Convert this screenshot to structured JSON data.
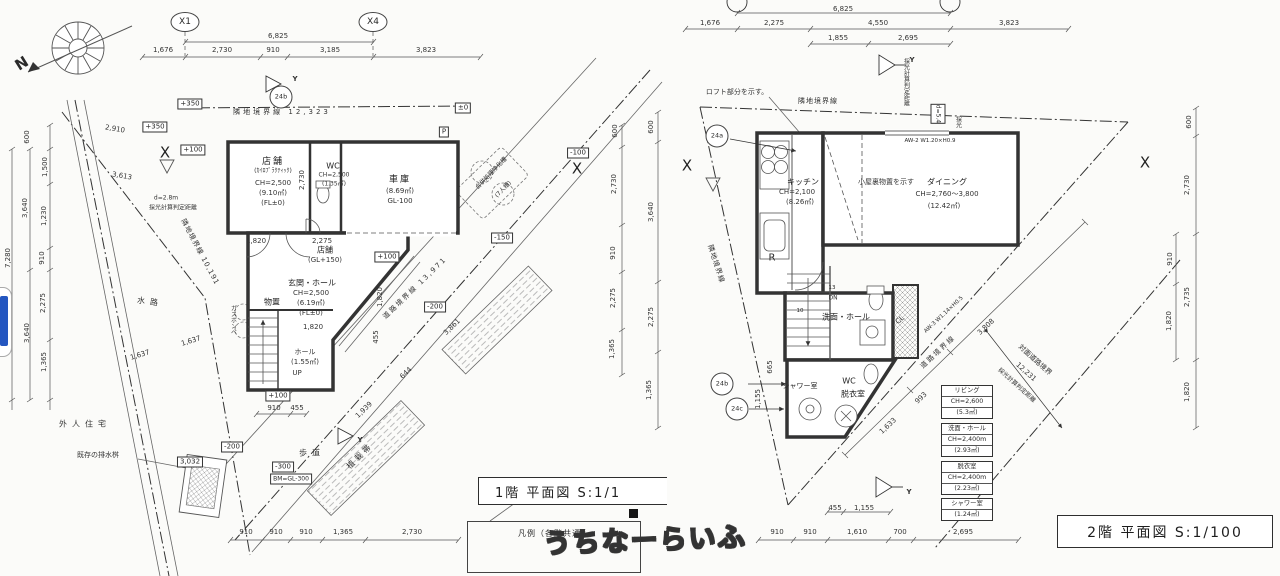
{
  "watermark": {
    "text": "うちなーらいふ"
  },
  "compass": {
    "north": "N"
  },
  "plan1": {
    "title": "1階 平面図 S:1/1",
    "legend_title": "凡例（各階共通）",
    "grid": {
      "x1": "X1",
      "x4": "X4"
    },
    "dims": {
      "top_total": "6,825",
      "top": [
        "1,676",
        "2,730",
        "910",
        "3,185",
        "3,823"
      ],
      "left": [
        "600",
        "1,500",
        "1,230",
        "910",
        "3,640",
        "7,280",
        "2,275",
        "1,365",
        "3,640"
      ],
      "right": [
        "600",
        "2,730",
        "910",
        "2,275",
        "1,365"
      ],
      "bottom": [
        "910",
        "910",
        "910",
        "1,365",
        "2,730"
      ],
      "bottom_sub": [
        "910",
        "455"
      ],
      "inner": {
        "a": "1,820",
        "b": "2,275",
        "c": "2,730",
        "d": "1,820",
        "e": "1,820",
        "f": "455",
        "g": "3,861",
        "h": "644",
        "i": "1,939",
        "j": "1,637",
        "k": "1,637",
        "l": "2,910",
        "m": "3,613"
      }
    },
    "levels": {
      "l1": "+350",
      "l2": "+350",
      "l3": "+100",
      "l4": "±0",
      "l5": "-100",
      "l6": "-150",
      "l7": "+100",
      "l8": "-200",
      "l9": "+100",
      "l10": "-200",
      "l11": "-300",
      "l12": "BM=GL-300",
      "l13": "3,032"
    },
    "rooms": {
      "tenpo": {
        "name": "店舗",
        "note": "(ｶｲﾛﾌﾟﾗｸﾃｨｯｸ)",
        "ch": "CH=2,500",
        "area": "(9.10㎡)",
        "fl": "(FL±0)"
      },
      "wc": {
        "name": "WC",
        "ch": "CH=2,500",
        "area": "(1.35㎡)"
      },
      "garage": {
        "name": "車庫",
        "area": "(8.69㎡)",
        "gl": "GL-100"
      },
      "tenpo2": {
        "name": "店舗",
        "gl": "(GL+150)"
      },
      "genkan": {
        "name": "玄関・ホール",
        "ch": "CH=2,500",
        "area": "(6.19㎡)",
        "fl": "(FL±0)"
      },
      "monooki": "物置",
      "hall": {
        "name": "ホール",
        "area": "(1.55㎡)"
      },
      "up": "UP"
    },
    "site": {
      "boundary_top": "隣地境界線 12,323",
      "boundary_left": "隣地境界線 10,191",
      "road_boundary": "道路境界線 13,971",
      "waterway": "水路",
      "neighbor": "外人住宅",
      "drain": "既存の排水桝",
      "sidewalk": "歩道",
      "planting": "植栽帯",
      "septic": "合併処理浄化槽",
      "septic_note": "(7人槽)",
      "daylight_d": "d=2.8m",
      "daylight": "採光計算判定距離",
      "gas": "ガスボンベ",
      "mark_p": "P",
      "mark_x1": "X",
      "mark_x2": "X",
      "mark_24": "24b",
      "mark_y1": "Y",
      "mark_y2": "Y"
    }
  },
  "plan2": {
    "title": "2階 平面図 S:1/100",
    "dims": {
      "top_total": "6,825",
      "top": [
        "1,676",
        "2,275",
        "4,550",
        "3,823"
      ],
      "top_sub": [
        "1,855",
        "2,695"
      ],
      "left": [
        "600",
        "3,640",
        "2,275",
        "1,365"
      ],
      "right_outer": [
        "600",
        "2,730",
        "2,735",
        "1,820"
      ],
      "right_inner": [
        "910",
        "1,820"
      ],
      "bottom": [
        "910",
        "910",
        "1,610",
        "700",
        "2,695"
      ],
      "bottom_sub": [
        "455",
        "1,155"
      ],
      "inner": {
        "a": "665",
        "b": "1,155",
        "c": "1,633",
        "d": "993",
        "e": "3,808"
      }
    },
    "rooms": {
      "kitchen": {
        "name": "キッチン",
        "ch": "CH=2,100",
        "area": "(8.26㎡)"
      },
      "dining": {
        "name": "ダイニング",
        "ch": "CH=2,760〜3,800",
        "area": "(12.42㎡)"
      },
      "senmen": "洗面・ホール",
      "cl": "CL",
      "wc": "WC",
      "datsui": "脱衣室",
      "shower": "シャワー室",
      "dn": "DN",
      "r": "R",
      "s10": "10",
      "s13": "13",
      "loft_note": "ロフト部分を示す。",
      "attic_note": "小屋裏物置を示す",
      "window1": "AW-2 W1.20×H0.9",
      "window2": "AW-3 W1.14×H0.5"
    },
    "site": {
      "boundary_top": "隣地境界線",
      "boundary_left": "隣地境界線",
      "road_boundary": "道路境界線",
      "opp1": "対面道路境界",
      "opp2": "12,231",
      "opp3": "採光計算判定距離",
      "daylight_v": "採光計算判定距離",
      "d54": "d=5.4",
      "sai": "採光",
      "mark_x1": "X",
      "mark_x2": "X",
      "mark_24a": "24a",
      "mark_24b": "24b",
      "mark_24c": "24c",
      "mark_y1": "Y",
      "mark_y2": "Y"
    },
    "tables": [
      {
        "name": "リビング",
        "ch": "CH=2,600",
        "area": "(5.3㎡)"
      },
      {
        "name": "洗面・ホール",
        "ch": "CH=2,400m",
        "area": "(2.93㎡)"
      },
      {
        "name": "脱衣室",
        "ch": "CH=2,400m",
        "area": "(2.23㎡)"
      },
      {
        "name": "シャワー室",
        "area": "(1.24㎡)"
      }
    ]
  }
}
